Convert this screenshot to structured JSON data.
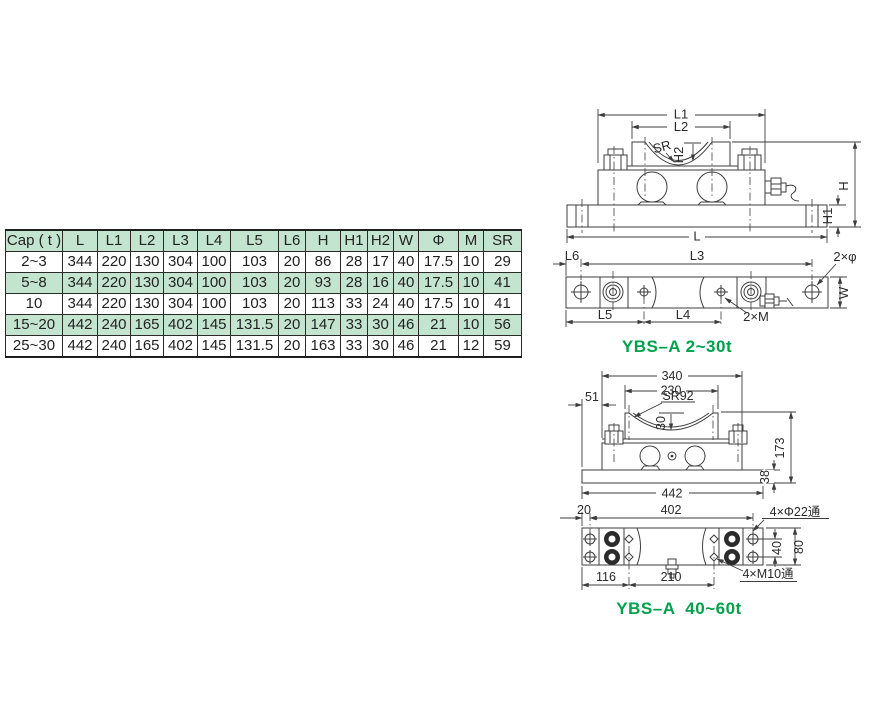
{
  "table": {
    "headers": [
      "Cap ( t )",
      "L",
      "L1",
      "L2",
      "L3",
      "L4",
      "L5",
      "L6",
      "H",
      "H1",
      "H2",
      "W",
      "Φ",
      "M",
      "SR"
    ],
    "rows": [
      [
        "2~3",
        "344",
        "220",
        "130",
        "304",
        "100",
        "103",
        "20",
        "86",
        "28",
        "17",
        "40",
        "17.5",
        "10",
        "29"
      ],
      [
        "5~8",
        "344",
        "220",
        "130",
        "304",
        "100",
        "103",
        "20",
        "93",
        "28",
        "16",
        "40",
        "17.5",
        "10",
        "41"
      ],
      [
        "10",
        "344",
        "220",
        "130",
        "304",
        "100",
        "103",
        "20",
        "113",
        "33",
        "24",
        "40",
        "17.5",
        "10",
        "41"
      ],
      [
        "15~20",
        "442",
        "240",
        "165",
        "402",
        "145",
        "131.5",
        "20",
        "147",
        "33",
        "30",
        "46",
        "21",
        "10",
        "56"
      ],
      [
        "25~30",
        "442",
        "240",
        "165",
        "402",
        "145",
        "131.5",
        "20",
        "163",
        "33",
        "30",
        "46",
        "21",
        "12",
        "59"
      ]
    ]
  },
  "drawings": {
    "front_small": {
      "l1": "L1",
      "l2": "L2",
      "sr": "SR",
      "h2": "H2",
      "l": "L",
      "h": "H",
      "h1": "H1"
    },
    "top_small": {
      "l6": "L6",
      "l3": "L3",
      "two_phi": "2×φ",
      "w": "W",
      "l5": "L5",
      "l4": "L4",
      "two_m": "2×M",
      "label": "YBS–A 2~30t"
    },
    "front_large": {
      "d340": "340",
      "d230": "230",
      "sr92": "SR92",
      "d51": "51",
      "d30": "30",
      "d173": "173",
      "d38": "38",
      "d442": "442"
    },
    "top_large": {
      "d20": "20",
      "d402": "402",
      "phi_holes": "4×Φ22通",
      "d40": "40",
      "d80": "80",
      "m_holes": "4×M10通",
      "d116": "116",
      "d210": "210",
      "label": "YBS–A  40~60t"
    }
  },
  "colors": {
    "table_green": "#c3e5cf",
    "label_green": "#00a14b",
    "line": "#3d3d3d"
  }
}
